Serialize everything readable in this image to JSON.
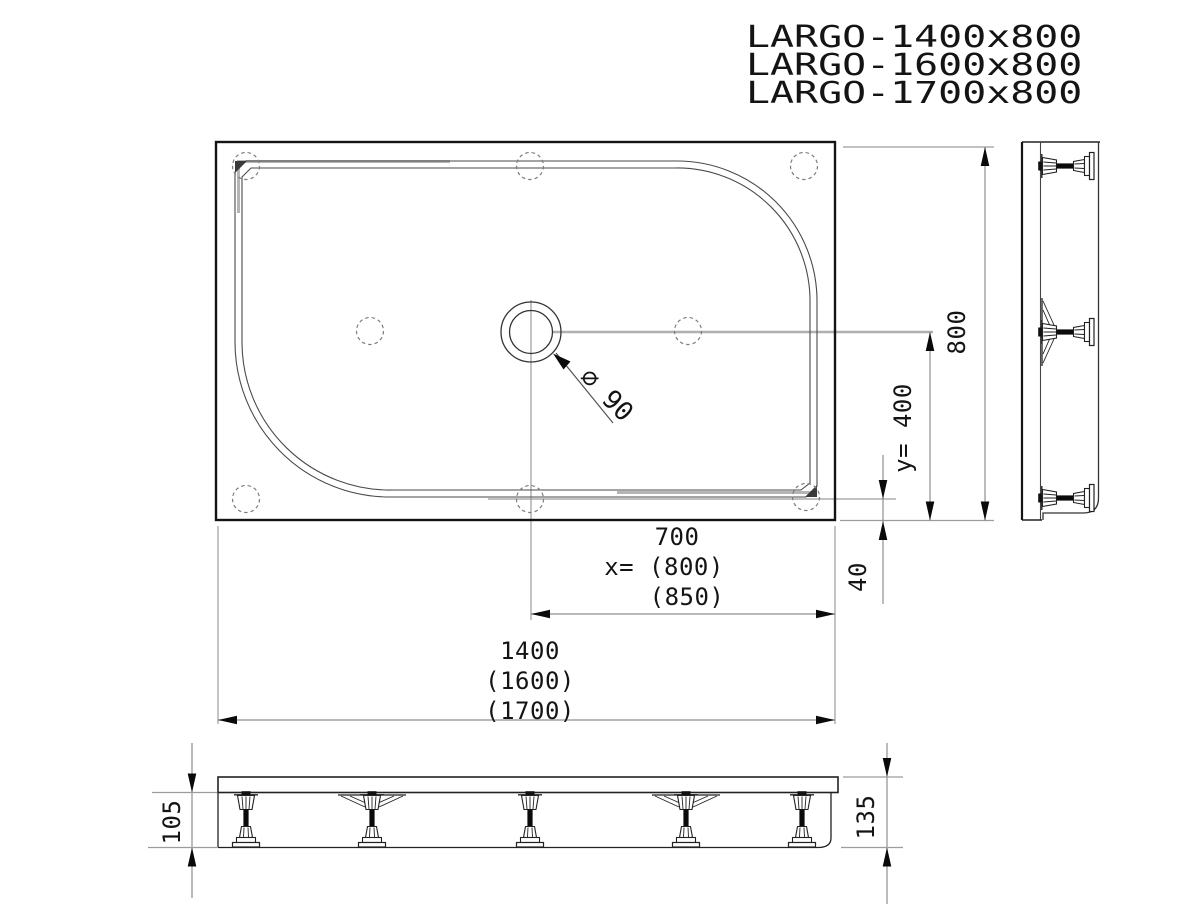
{
  "title_block": {
    "models": [
      "LARGO-1400x800",
      "LARGO-1600x800",
      "LARGO-1700x800"
    ]
  },
  "plan_view": {
    "drain_diameter_label": "⌀ 90",
    "feet_count_plan": 8,
    "drain": {
      "outer_radius_px": 30,
      "inner_radius_px": 21.5
    }
  },
  "dimensions": {
    "overall_width_lines": [
      "1400",
      "(1600)",
      "(1700)"
    ],
    "drain_x_lines": [
      "700",
      "x= (800)",
      "(850)"
    ],
    "overall_depth": "800",
    "drain_y": "y= 400",
    "foot_to_edge": "40",
    "leg_height": "105",
    "total_height": "135"
  },
  "colors": {
    "background": "#ffffff",
    "outline_heavy": "#141414",
    "outline_thin": "#444444",
    "extension_gray": "#9c9c9c",
    "overlay_gray": "#b5b5b5",
    "dashed_gray": "#7d7d7d",
    "text": "#141414"
  }
}
